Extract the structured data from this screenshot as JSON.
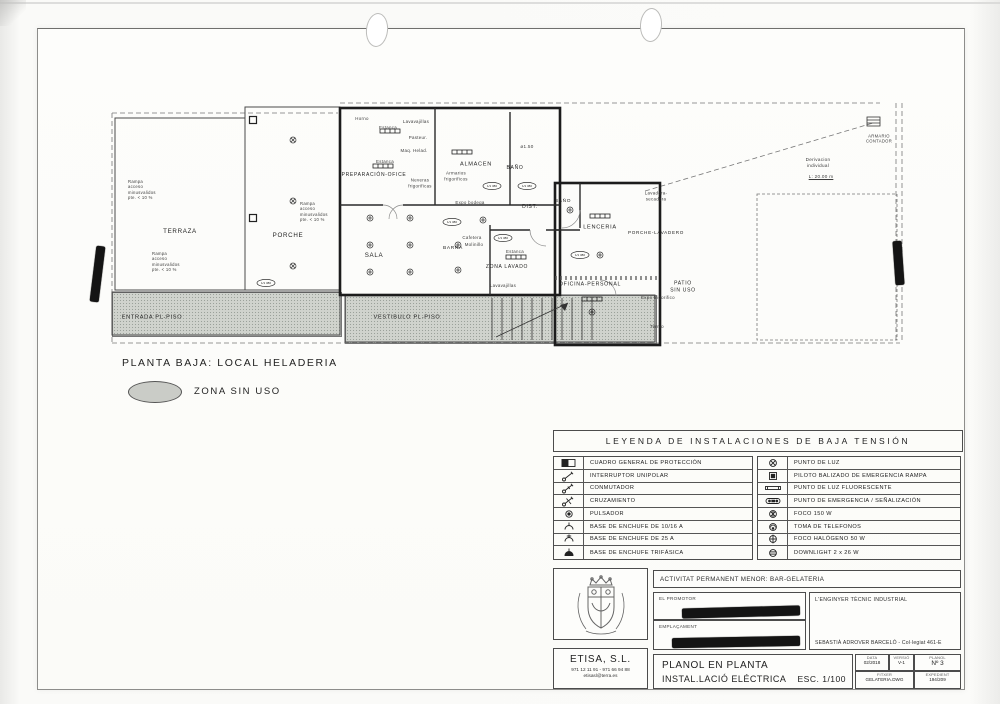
{
  "colors": {
    "paper": "#fdfdfb",
    "ink": "#2d2d2d",
    "gray_zone": "#d0d3cd",
    "redaction": "#141414"
  },
  "caption": {
    "plan_title": "PLANTA BAJA: LOCAL HELADERIA",
    "zona_sin_uso": "ZONA SIN USO"
  },
  "plan": {
    "tag_text": "1/1 380",
    "labels": [
      {
        "t": "TERRAZA",
        "x": 80,
        "y": 142,
        "fs": 6.2,
        "cls": "room"
      },
      {
        "t": "PORCHE",
        "x": 188,
        "y": 146,
        "fs": 6.2,
        "cls": "room"
      },
      {
        "t": "SALA",
        "x": 274,
        "y": 166,
        "fs": 6.2,
        "cls": "room"
      },
      {
        "t": "BARRA",
        "x": 353,
        "y": 159,
        "fs": 4.8,
        "cls": "room"
      },
      {
        "t": "PREPARACIÓN-OFICE",
        "x": 274,
        "y": 85,
        "fs": 5,
        "cls": "room"
      },
      {
        "t": "ALMACEN",
        "x": 376,
        "y": 75,
        "fs": 5.6,
        "cls": "room"
      },
      {
        "t": "BAÑO",
        "x": 415,
        "y": 78,
        "fs": 5,
        "cls": "room"
      },
      {
        "t": "DIST.",
        "x": 430,
        "y": 117,
        "fs": 5,
        "cls": "room"
      },
      {
        "t": "BAÑO",
        "x": 463,
        "y": 112,
        "fs": 4.8,
        "cls": "room"
      },
      {
        "t": "LENCERIA",
        "x": 500,
        "y": 138,
        "fs": 5.6,
        "cls": "room"
      },
      {
        "t": "ZONA LAVADO",
        "x": 407,
        "y": 177,
        "fs": 5,
        "cls": "room"
      },
      {
        "t": "OFICINA-PERSONAL",
        "x": 490,
        "y": 195,
        "fs": 5.2,
        "cls": "room"
      },
      {
        "t": "PORCHE-LAVADERO",
        "x": 556,
        "y": 143,
        "fs": 4.6,
        "cls": "room"
      },
      {
        "t": "PATIO\nSIN USO",
        "x": 583,
        "y": 197,
        "fs": 5,
        "cls": "room"
      },
      {
        "t": "VESTIBULO PL-PISO",
        "x": 307,
        "y": 228,
        "fs": 5.6,
        "cls": "room"
      },
      {
        "t": "ENTRADA PL-PISO",
        "x": 52,
        "y": 228,
        "fs": 5.6,
        "cls": "room"
      },
      {
        "t": "Horno",
        "x": 262,
        "y": 29,
        "fs": 4.4
      },
      {
        "t": "Estanca",
        "x": 288,
        "y": 38,
        "fs": 4.4
      },
      {
        "t": "Lavavajillas",
        "x": 316,
        "y": 32,
        "fs": 4.4
      },
      {
        "t": "Pasteur.",
        "x": 318,
        "y": 48,
        "fs": 4.4
      },
      {
        "t": "Maq. Helad.",
        "x": 314,
        "y": 61,
        "fs": 4.4
      },
      {
        "t": "Estanca",
        "x": 285,
        "y": 72,
        "fs": 4.4
      },
      {
        "t": "Neveras\nfrigorificas",
        "x": 320,
        "y": 93,
        "fs": 4.4
      },
      {
        "t": "Armarios\nfrigorificos",
        "x": 356,
        "y": 86,
        "fs": 4.4
      },
      {
        "t": "Expo bodega",
        "x": 370,
        "y": 113,
        "fs": 4.4
      },
      {
        "t": "ø1.50",
        "x": 427,
        "y": 57,
        "fs": 4.6
      },
      {
        "t": "Cafetera",
        "x": 372,
        "y": 148,
        "fs": 4.4
      },
      {
        "t": "Molinillo",
        "x": 374,
        "y": 155,
        "fs": 4.4
      },
      {
        "t": "Estanca",
        "x": 415,
        "y": 162,
        "fs": 4.4
      },
      {
        "t": "Lavavajillas",
        "x": 403,
        "y": 196,
        "fs": 4.4
      },
      {
        "t": "Lavadora-\nsecadora",
        "x": 556,
        "y": 106,
        "fs": 4.4
      },
      {
        "t": "Expo frigorifico",
        "x": 558,
        "y": 208,
        "fs": 4.4
      },
      {
        "t": "Termo",
        "x": 557,
        "y": 237,
        "fs": 4.4
      },
      {
        "t": "ARMARIO\nCONTADOR",
        "x": 779,
        "y": 49,
        "fs": 4.2
      },
      {
        "t": "Derivacion\nindividual",
        "x": 718,
        "y": 73,
        "fs": 4.6
      },
      {
        "t": "L:  20.00 m",
        "x": 721,
        "y": 87,
        "fs": 4.6,
        "u": 1
      },
      {
        "t": "Rampa\nacceso\nminusvalidos\npte. < 10 %",
        "x": 28,
        "y": 100,
        "fs": 4.2,
        "cls": "note-left"
      },
      {
        "t": "Rampa\nacceso\nminusvalidos\npte. < 10 %",
        "x": 200,
        "y": 122,
        "fs": 4.2,
        "cls": "note-left"
      },
      {
        "t": "Rampa\nacceso\nminusvalidos\npte. < 10 %",
        "x": 52,
        "y": 172,
        "fs": 4.2,
        "cls": "note-left"
      }
    ],
    "symbols": {
      "porche_lights": [
        [
          193,
          50
        ],
        [
          193,
          111
        ],
        [
          193,
          176
        ]
      ],
      "ceiling_lights": [
        [
          270,
          128
        ],
        [
          310,
          128
        ],
        [
          383,
          130
        ],
        [
          270,
          155
        ],
        [
          310,
          155
        ],
        [
          358,
          155
        ],
        [
          270,
          182
        ],
        [
          310,
          182
        ],
        [
          358,
          180
        ],
        [
          470,
          120
        ],
        [
          500,
          165
        ],
        [
          492,
          222
        ]
      ],
      "fluorescent_bars": [
        [
          362,
          62
        ],
        [
          500,
          126
        ],
        [
          492,
          209
        ],
        [
          290,
          41
        ],
        [
          283,
          76
        ],
        [
          416,
          167
        ]
      ],
      "circuit_tags": [
        [
          166,
          193
        ],
        [
          352,
          132
        ],
        [
          392,
          96
        ],
        [
          427,
          96
        ],
        [
          403,
          148
        ],
        [
          480,
          165
        ]
      ],
      "columns": [
        [
          153,
          30
        ],
        [
          153,
          128
        ]
      ]
    }
  },
  "legend": {
    "title": "LEYENDA DE INSTALACIONES DE BAJA TENSIÓN",
    "left": [
      {
        "icon": "cuadro-general-icon",
        "label": "CUADRO GENERAL DE PROTECCIÓN"
      },
      {
        "icon": "interruptor-unipolar-icon",
        "label": "INTERRUPTOR UNIPOLAR"
      },
      {
        "icon": "conmutador-icon",
        "label": "CONMUTADOR"
      },
      {
        "icon": "cruzamiento-icon",
        "label": "CRUZAMIENTO"
      },
      {
        "icon": "pulsador-icon",
        "label": "PULSADOR"
      },
      {
        "icon": "enchufe-10-16-icon",
        "label": "BASE DE ENCHUFE DE 10/16 A"
      },
      {
        "icon": "enchufe-25-icon",
        "label": "BASE DE ENCHUFE DE 25 A"
      },
      {
        "icon": "enchufe-trifasica-icon",
        "label": "BASE DE ENCHUFE TRIFÁSICA"
      }
    ],
    "right": [
      {
        "icon": "punto-de-luz-icon",
        "label": "PUNTO DE LUZ"
      },
      {
        "icon": "piloto-emergencia-icon",
        "label": "PILOTO BALIZADO DE EMERGENCIA RAMPA"
      },
      {
        "icon": "fluorescente-icon",
        "label": "PUNTO DE LUZ FLUORESCENTE"
      },
      {
        "icon": "emergencia-senalizacion-icon",
        "label": "PUNTO DE EMERGENCIA / SEÑALIZACIÓN"
      },
      {
        "icon": "foco-150-icon",
        "label": "FOCO 150 W"
      },
      {
        "icon": "toma-telefonos-icon",
        "label": "TOMA DE TELEFONOS"
      },
      {
        "icon": "foco-halogeno-icon",
        "label": "FOCO HALÓGENO 50 W"
      },
      {
        "icon": "downlight-icon",
        "label": "DOWNLIGHT 2 x 26 W"
      }
    ]
  },
  "titleblock": {
    "activity": "ACTIVITAT PERMANENT MENOR: BAR-GELATERIA",
    "promoter_label": "EL PROMOTOR",
    "location_label": "EMPLAÇAMENT",
    "engineer_label": "L'ENGINYER TÈCNIC INDUSTRIAL",
    "engineer_name": "SEBASTIÀ ADROVER BARCELÓ - Col·legiat 461-E",
    "company": "ETISA, S.L.",
    "company_phone": "971 12 11 91 - 971 66 94 88",
    "company_email": "etisasl@terra.es",
    "drawing_title_1": "PLANOL EN PLANTA",
    "drawing_title_2": "INSTAL.LACIÓ ELÉCTRICA",
    "scale": "ESC. 1/100",
    "fields": {
      "data_label": "DATA",
      "data_value": "02/2018",
      "versio_label": "VERSIÓ",
      "versio_value": "V-1",
      "planol_label": "PLANOL",
      "planol_value": "Nº 3",
      "fitxer_label": "FITXER",
      "fitxer_value": "GELATERIA.DWG",
      "expedient_label": "EXPEDIENT",
      "expedient_value": "194/209"
    }
  }
}
